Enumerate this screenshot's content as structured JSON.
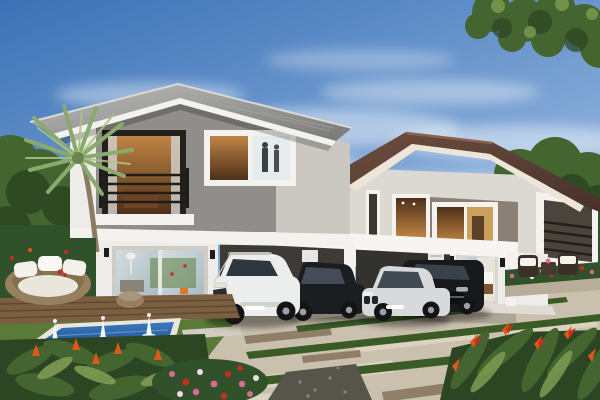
{
  "scene": {
    "description": "Photorealistic architectural rendering of two modern two-storey houses with carports, four parked cars, a fountain pool, round wicker daybed, wooden deck and landscaped tropical garden under a blue sky with wispy clouds",
    "objects": [
      "sky",
      "clouds",
      "shade-tree-canopy",
      "palm-tree",
      "background-treeline",
      "left-house",
      "left-house-roof",
      "left-house-balcony",
      "left-house-corner-window",
      "left-house-glass-doors",
      "left-house-carport",
      "right-house",
      "right-house-roof",
      "right-house-balcony",
      "right-house-windows",
      "right-house-glass-doors",
      "right-house-carport",
      "white-suv",
      "black-sedan",
      "silver-sedan",
      "black-suv",
      "driveway",
      "paving-slabs",
      "grass-strips",
      "gravel-patch",
      "lawn",
      "fountain-pool",
      "wooden-deck",
      "wicker-daybed",
      "wicker-stool",
      "patio-furniture-set",
      "hedge",
      "flower-border",
      "red-flower-shrubs",
      "pink-flower-bush",
      "orange-heliconia-flowers"
    ]
  },
  "colors": {
    "skyTop": "#3c72b6",
    "skyMid": "#85aad8",
    "skyLow": "#d8e6f4",
    "cloud": "#ffffff",
    "foliageDark": "#2c4522",
    "foliageMid": "#44652f",
    "foliageLight": "#7e9c52",
    "hedge": "#31512a",
    "palmGreen": "#8aa96d",
    "palmTrunk": "#8d7b60",
    "roofLeftLight": "#bdbdbb",
    "roofLeftDark": "#787876",
    "fasciaWhite": "#f4f2ee",
    "wallWhite": "#edece8",
    "wallGray": "#8f8e8a",
    "wallLightGray": "#cbc8c2",
    "roofBrown": "#6f4f40",
    "roofBrownDark": "#46312a",
    "taupe": "#8c8076",
    "beamWhite": "#f6f5f1",
    "carportDark": "#3e3b37",
    "glassBlue": "#a7b9c1",
    "interiorWarm": "#c08444",
    "interiorDark": "#4e3019",
    "lawn": "#5a7b38",
    "lawnLight": "#79a04a",
    "drive": "#c9c0ae",
    "slabLight": "#ddd4c1",
    "slabDark": "#8f7f68",
    "gravel": "#57544c",
    "grassStrip": "#3a5a26",
    "poolWater": "#3b79c0",
    "poolDeep": "#1c4a85",
    "poolRim": "#eae6dc",
    "deck": "#7c5f41",
    "deckDark": "#5f4830",
    "rattan": "#96805f",
    "cushionWhite": "#f4f1ea",
    "flowerRed": "#c52f22",
    "flowerOrange": "#e0571c",
    "flowerPink": "#d96c93",
    "carWhite": "#eceeed",
    "carBlack": "#1b1d20",
    "carSilver": "#d7d9da",
    "carGlass": "#2e363e",
    "tyre": "#141414",
    "hub": "#9aa0a6"
  }
}
